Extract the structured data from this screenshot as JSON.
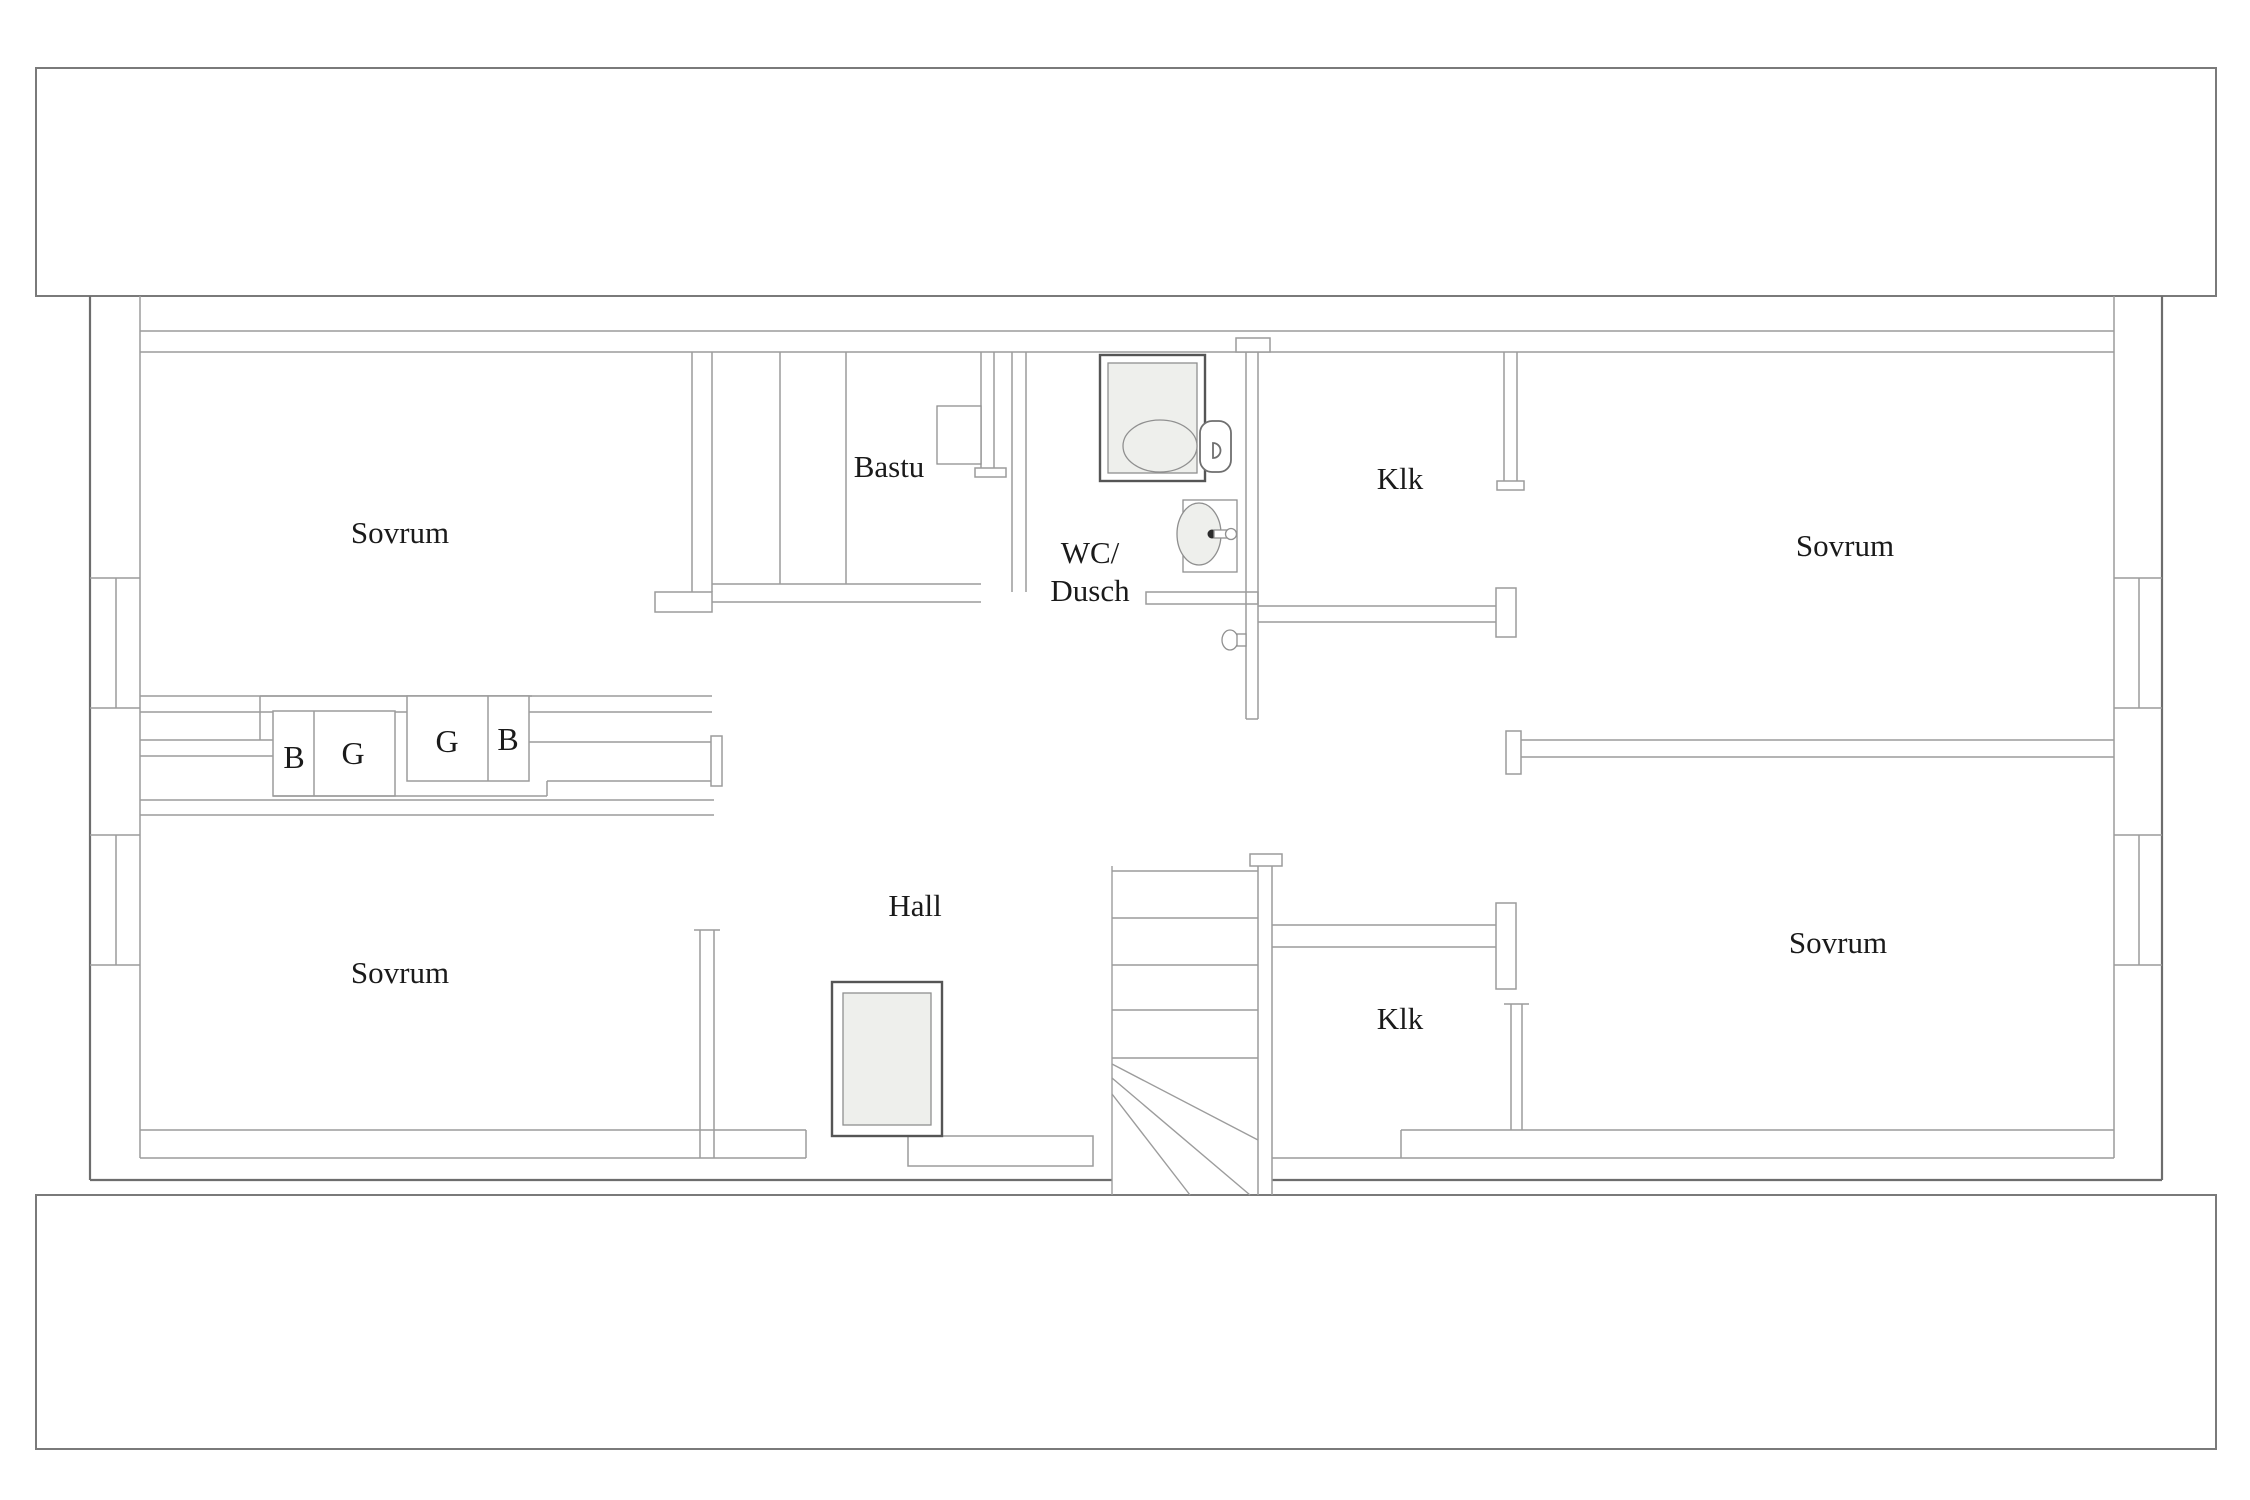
{
  "plan": {
    "type": "floor-plan",
    "language": "Swedish",
    "labels": {
      "sovrum_top_left": "Sovrum",
      "sovrum_top_right": "Sovrum",
      "sovrum_bottom_left": "Sovrum",
      "sovrum_bottom_right": "Sovrum",
      "bastu": "Bastu",
      "wc_dusch_line1": "WC/",
      "wc_dusch_line2": "Dusch",
      "klk_top": "Klk",
      "klk_bottom": "Klk",
      "hall": "Hall",
      "closet_1": "B",
      "closet_2": "G",
      "closet_3": "G",
      "closet_4": "B"
    },
    "fixtures": [
      "shower-tray",
      "toilet",
      "sink",
      "sauna-benches",
      "sauna-heater",
      "skylight",
      "staircase",
      "door-handle",
      "window-niche"
    ],
    "colors": {
      "background": "#ffffff",
      "interior_wall": "#9c9c9c",
      "outer_wall": "#6d6d6d",
      "roof_band": "#7a7a7a",
      "fixture_outline": "#6f6f6f",
      "light_fill": "#eeefec",
      "text": "#1a1a1a"
    }
  }
}
